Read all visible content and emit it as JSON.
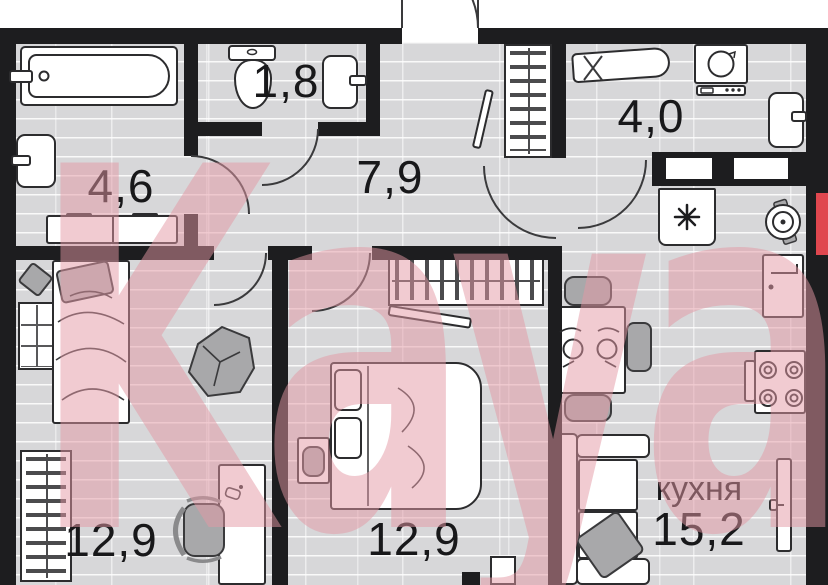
{
  "watermark": {
    "text": "Kayan"
  },
  "rooms": {
    "bathroom": {
      "area": "4,6"
    },
    "toilet": {
      "area": "1,8"
    },
    "hallway": {
      "area": "7,9"
    },
    "laundry": {
      "area": "4,0"
    },
    "bedroom_left": {
      "area": "12,9"
    },
    "bedroom_middle": {
      "area": "12,9"
    },
    "kitchen": {
      "name": "кухня",
      "area": "15,2"
    }
  },
  "colors": {
    "wall": "#1d1d1f",
    "floor": "#d7d7d9",
    "watermark_pink": "#eeb4be",
    "accent_red": "#e0474f"
  }
}
